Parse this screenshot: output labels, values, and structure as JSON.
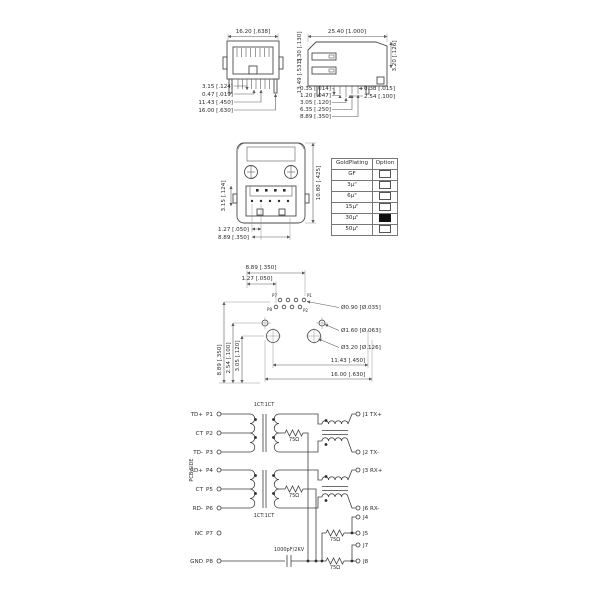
{
  "colors": {
    "line": "#4a4a4a",
    "dim_line": "#5a5a5a",
    "text": "#2b2b2b",
    "selected_fill": "#101010",
    "background": "#ffffff"
  },
  "front_view": {
    "dim_top": "16.20 [.638]",
    "dims_left": [
      "3.15 [.124]",
      "0.47 [.019]",
      "11.43 [.450]",
      "16.00 [.630]"
    ]
  },
  "side_view": {
    "dim_top": "25.40 [1.000]",
    "dim_left_upper": "3.30 [.130]",
    "dim_left_lower": "13.49 [.531]",
    "dims_bottom_left": [
      "0.35 [.014]",
      "1.20 [.047]",
      "3.05 [.120]",
      "6.35 [.250]",
      "8.89 [.350]"
    ],
    "dims_bottom_right": [
      "0.38 [.015]",
      "2.54 [.100]"
    ],
    "dim_right": "3.20 [.126]"
  },
  "bottom_view": {
    "dim_left": "3.15 [.124]",
    "dim_right": "10.80 [.425]",
    "dim_bottom_a": "1.27 [.050]",
    "dim_bottom_b": "8.89 [.350]"
  },
  "plating_table": {
    "headers": [
      "GoldPlating",
      "Option"
    ],
    "rows": [
      {
        "label": "GF",
        "selected": false
      },
      {
        "label": "3µ\"",
        "selected": false
      },
      {
        "label": "6µ\"",
        "selected": false
      },
      {
        "label": "15µ\"",
        "selected": false
      },
      {
        "label": "30µ\"",
        "selected": true
      },
      {
        "label": "50µ\"",
        "selected": false
      }
    ]
  },
  "footprint": {
    "dim_top_a": "8.89 [.350]",
    "dim_top_b": "1.27 [.050]",
    "callouts": [
      "Ø0.90 [Ø.035]",
      "Ø1.60 [Ø.063]",
      "Ø3.20 [Ø.126]"
    ],
    "dims_left": [
      "8.89 [.350]",
      "2.54 [.100]",
      "3.05 [.120]"
    ],
    "dims_bottom": [
      "11.43 [.450]",
      "16.00 [.630]"
    ],
    "pin_labels": {
      "top_left": "P7",
      "top_right": "P1",
      "bottom_left": "P8",
      "bottom_right": "P2"
    }
  },
  "schematic": {
    "side_label": "PCB SIDE",
    "ratio_top": "1CT:1CT",
    "ratio_bottom": "1CT:1CT",
    "pins": [
      {
        "name": "TD+",
        "num": "P1"
      },
      {
        "name": "CT",
        "num": "P2"
      },
      {
        "name": "TD-",
        "num": "P3"
      },
      {
        "name": "RD+",
        "num": "P4"
      },
      {
        "name": "CT",
        "num": "P5"
      },
      {
        "name": "RD-",
        "num": "P6"
      },
      {
        "name": "NC",
        "num": "P7"
      },
      {
        "name": "GND",
        "num": "P8"
      }
    ],
    "outputs": [
      "J1 TX+",
      "J2 TX-",
      "J3 RX+",
      "J6 RX-",
      "J4",
      "J5",
      "J7",
      "J8"
    ],
    "resistor_value": "75Ω",
    "cap_value": "1000pF/2KV"
  }
}
